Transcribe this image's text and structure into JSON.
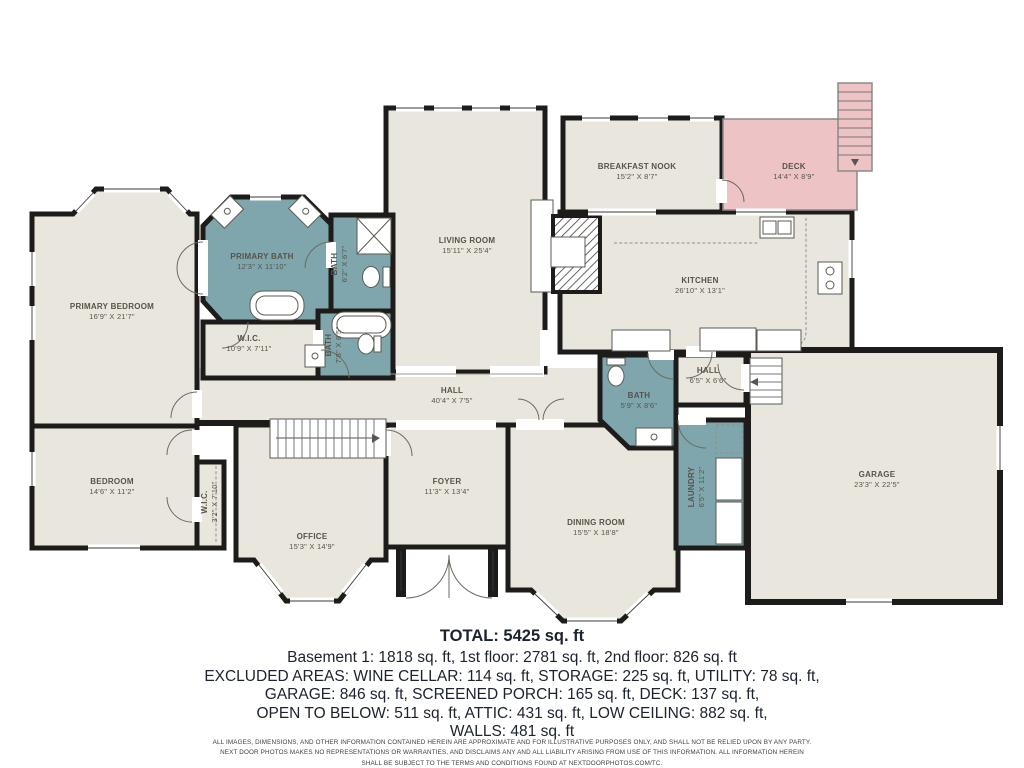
{
  "plan": {
    "rooms": {
      "primary_bedroom": {
        "name": "PRIMARY BEDROOM",
        "dims": "16'9\" X 21'7\""
      },
      "primary_bath": {
        "name": "PRIMARY BATH",
        "dims": "12'3\" X 11'10\""
      },
      "bath_upper": {
        "name": "BATH",
        "dims": "6'2\" X 6'7\""
      },
      "wic_primary": {
        "name": "W.I.C.",
        "dims": "10'9\" X 7'11\""
      },
      "bath_mid": {
        "name": "BATH",
        "dims": "7'8\" X 8'5\""
      },
      "living_room": {
        "name": "LIVING ROOM",
        "dims": "15'11\" X 25'4\""
      },
      "breakfast_nook": {
        "name": "BREAKFAST NOOK",
        "dims": "15'2\" X 8'7\""
      },
      "deck": {
        "name": "DECK",
        "dims": "14'4\" X 8'9\""
      },
      "kitchen": {
        "name": "KITCHEN",
        "dims": "26'10\" X 13'1\""
      },
      "hall": {
        "name": "HALL",
        "dims": "40'4\" X 7'5\""
      },
      "bath_lower": {
        "name": "BATH",
        "dims": "5'9\" X 8'6\""
      },
      "hall_small": {
        "name": "HALL",
        "dims": "6'5\" X 6'6\""
      },
      "laundry": {
        "name": "LAUNDRY",
        "dims": "6'5\" X 11'2\""
      },
      "bedroom": {
        "name": "BEDROOM",
        "dims": "14'6\" X 11'2\""
      },
      "wic_small": {
        "name": "W.I.C.",
        "dims": "3'2\" X 7'10\""
      },
      "office": {
        "name": "OFFICE",
        "dims": "15'3\" X 14'9\""
      },
      "foyer": {
        "name": "FOYER",
        "dims": "11'3\" X 13'4\""
      },
      "dining_room": {
        "name": "DINING ROOM",
        "dims": "15'5\" X 18'8\""
      },
      "garage": {
        "name": "GARAGE",
        "dims": "23'3\" X 22'5\""
      }
    },
    "colors": {
      "floor": "#e9e7dd",
      "bath": "#7fa6ad",
      "deck": "#eec3c6",
      "wall": "#1d1c1a"
    }
  },
  "summary": {
    "total": "TOTAL: 5425 sq. ft",
    "lines": [
      "Basement 1: 1818 sq. ft, 1st floor: 2781 sq. ft, 2nd floor: 826 sq. ft",
      "EXCLUDED AREAS: WINE CELLAR: 114 sq. ft, STORAGE: 225 sq. ft, UTILITY: 78 sq. ft,",
      "GARAGE: 846 sq. ft, SCREENED PORCH: 165 sq. ft, DECK: 137 sq. ft,",
      "OPEN TO BELOW: 511 sq. ft, ATTIC: 431 sq. ft, LOW CEILING: 882 sq. ft,",
      "WALLS: 481 sq. ft"
    ]
  },
  "disclaimer": {
    "lines": [
      "ALL IMAGES, DIMENSIONS, AND OTHER INFORMATION CONTAINED HEREIN ARE APPROXIMATE AND FOR ILLUSTRATIVE PURPOSES ONLY, AND SHALL NOT BE RELIED UPON BY ANY PARTY.",
      "NEXT DOOR PHOTOS MAKES NO REPRESENTATIONS OR WARRANTIES, AND DISCLAIMS ANY AND ALL LIABILITY ARISING FROM USE OF THIS INFORMATION. ALL INFORMATION HEREIN",
      "SHALL BE SUBJECT TO THE TERMS AND CONDITIONS FOUND AT NEXTDOORPHOTOS.COM/TC."
    ]
  }
}
